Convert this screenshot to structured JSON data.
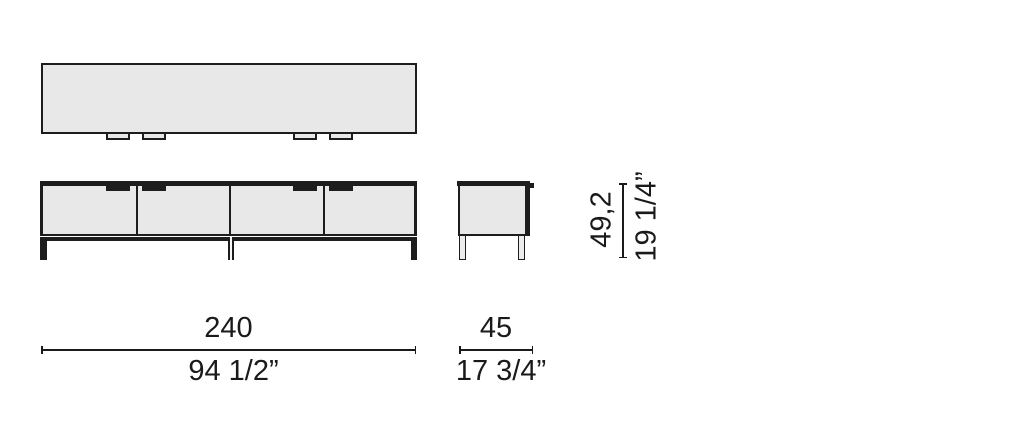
{
  "dimensions": {
    "width": {
      "cm": "240",
      "inches": "94 1/2”"
    },
    "depth": {
      "cm": "45",
      "inches": "17 3/4”"
    },
    "height": {
      "cm": "49,2",
      "inches": "19 1/4”"
    }
  },
  "colors": {
    "outline": "#1d1d1d",
    "panel_fill": "#e8e8e8",
    "text": "#1a1a1a",
    "background": "#ffffff"
  }
}
